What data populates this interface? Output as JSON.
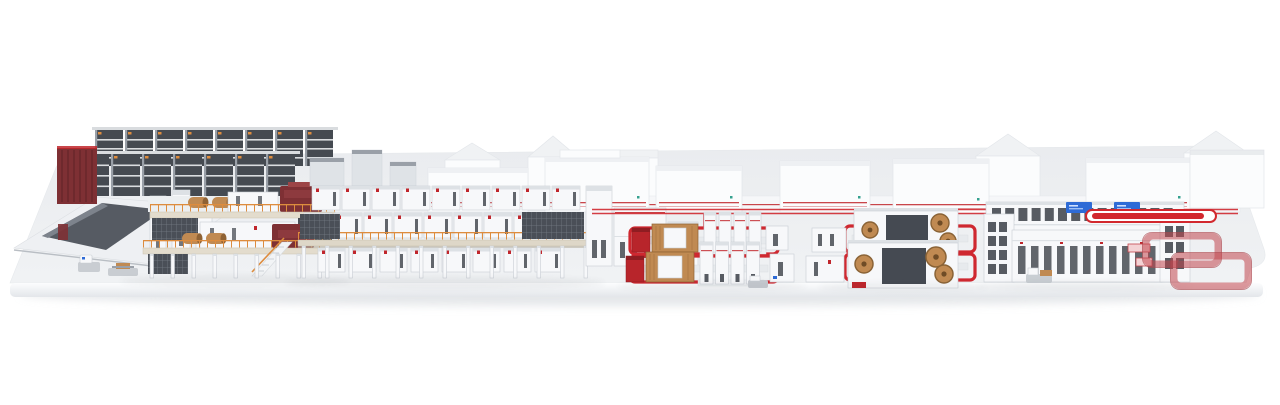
{
  "scene": {
    "name": "corrugated-board-production-line-3d-render",
    "background": "#ffffff",
    "visible_text": ""
  },
  "colors": {
    "platform_top": "#f0f2f4",
    "platform_top_back": "#eaecef",
    "platform_face": "#fcfdfe",
    "platform_face_shade": "#e3e6ea",
    "shadow": "#d3d7db",
    "white_machine": "#f7f8fa",
    "machine_shade": "#dde1e5",
    "machine_outline": "#c9ced4",
    "dark_panel": "#4a4f57",
    "dark_slot": "#3b4047",
    "rack_gray": "#9aa0a8",
    "rack_light": "#d9dcdf",
    "rack_dark": "#454a51",
    "red_accent": "#c0262c",
    "red_bright": "#d2282e",
    "dark_red": "#7e3034",
    "wood": "#c08a52",
    "wood_dark": "#8f6234",
    "orange": "#dd8c3e",
    "blue_screen": "#2e6bd6",
    "teal_logo": "#35a18f",
    "floor_line_red": "#cf2830",
    "loop_ring": "rgba(193,70,76,0.55)",
    "loop_fill": "#f3d2d4",
    "bg_building": "#fbfcfd",
    "bg_roof": "#f0f2f4",
    "bg_outline": "#e3e6ea",
    "steel": "#dfe3e7",
    "steel_dark": "#9aa0a8"
  },
  "counts": {
    "corrugator_upper_modules": 9,
    "corrugator_middle_modules": 9,
    "corrugator_lower_modules": 8,
    "bridge_columns": 13,
    "wet_end_columns": 9,
    "rack_back_bays": 8,
    "rack_front_bays": 7,
    "logistics_windows": 14,
    "logistics_doors": 11,
    "paper_rolls_upper": 2,
    "paper_rolls_lower": 2,
    "status_screens": 2,
    "floor_loops": 4
  },
  "sections": [
    {
      "id": "roll-storage-racks",
      "label": "paper roll storage racks"
    },
    {
      "id": "roll-handling-area",
      "label": "roll handling table and AGVs"
    },
    {
      "id": "wet-end",
      "label": "corrugator wet end with splicers"
    },
    {
      "id": "corrugator-bridge",
      "label": "elevated corrugator bridge"
    },
    {
      "id": "dry-end",
      "label": "dry end cabinets"
    },
    {
      "id": "converting-line-a",
      "label": "converting machines loop A"
    },
    {
      "id": "converting-line-b",
      "label": "converting machines loop B"
    },
    {
      "id": "logistics-complex",
      "label": "palletizing and logistics hall"
    },
    {
      "id": "sorting-loops",
      "label": "shipping sorter loops"
    }
  ]
}
